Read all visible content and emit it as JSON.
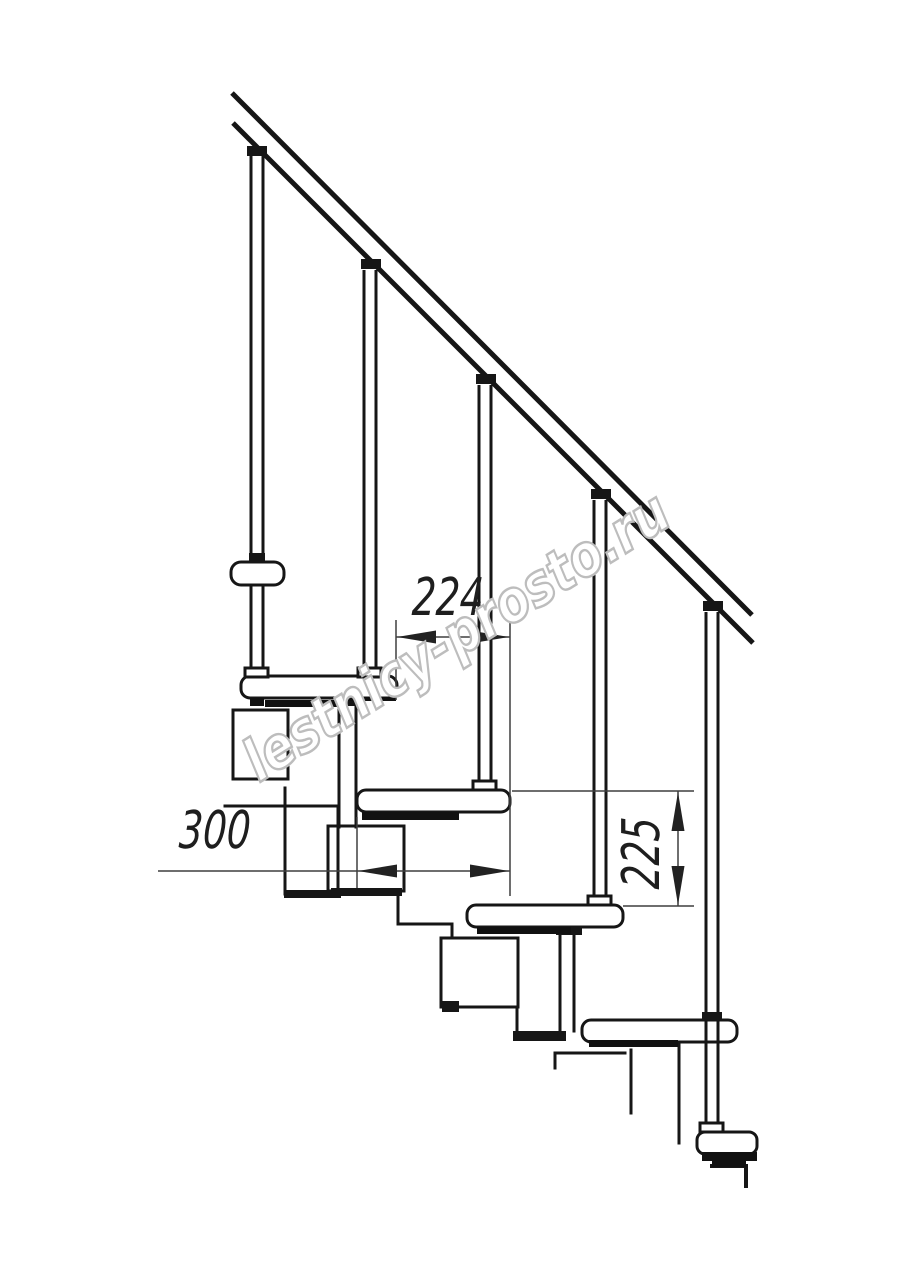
{
  "drawing": {
    "subject": "modular-staircase-side-view",
    "watermark_text": "lestnicy-prosto.ru",
    "dimensions": {
      "step_going_mm": "224",
      "tread_depth_mm": "300",
      "riser_height_mm": "225"
    },
    "colors": {
      "ink": "#161616",
      "dimension_line": "#3f3f3f",
      "watermark": "#bdbdbd",
      "background": "#ffffff"
    }
  }
}
